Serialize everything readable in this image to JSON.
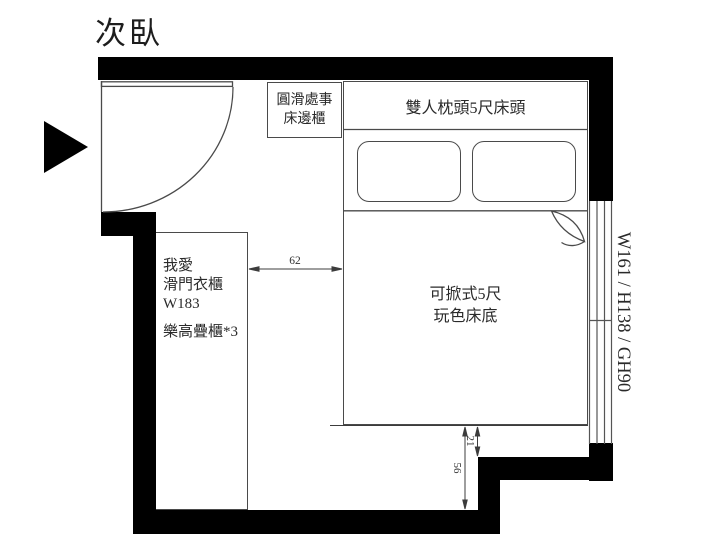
{
  "title": "次臥",
  "colors": {
    "wall": "#000000",
    "line": "#4a4a4a",
    "text": "#2a2a2a",
    "background": "#ffffff"
  },
  "entrance": {
    "icon": "entrance-arrow"
  },
  "furniture": {
    "bedside_cabinet": {
      "line1": "圓滑處事",
      "line2": "床邊櫃"
    },
    "headboard": {
      "label": "雙人枕頭5尺床頭"
    },
    "bed_base": {
      "line1": "可掀式5尺",
      "line2": "玩色床底"
    },
    "wardrobe": {
      "line1": "我愛",
      "line2": "滑門衣櫃",
      "line3": "W183",
      "line4": "樂高疊櫃*3"
    }
  },
  "window": {
    "spec": "W161 / H138 / GH90"
  },
  "dimensions": {
    "wardrobe_to_bed": "62",
    "bed_to_step": "21",
    "bed_to_wall": "56"
  }
}
